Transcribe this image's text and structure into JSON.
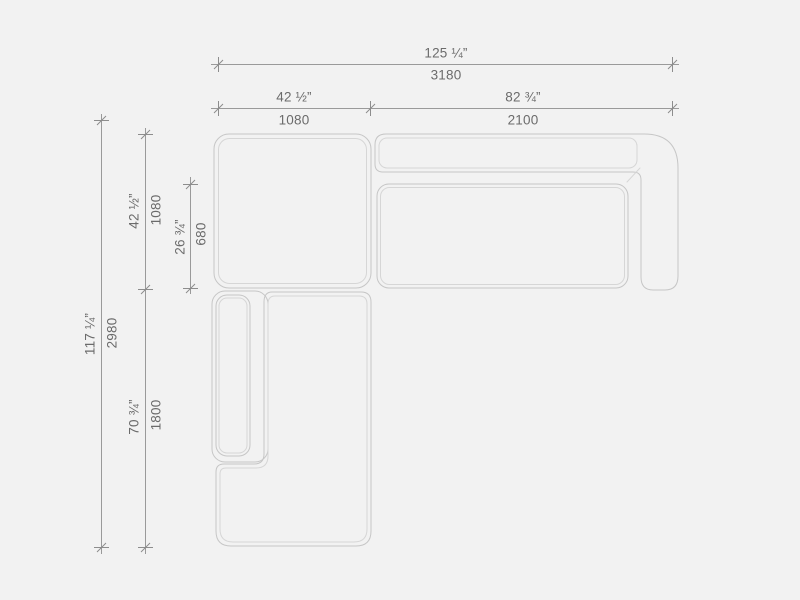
{
  "drawing": {
    "subject": "sectional-sofa-top-view",
    "modules": [
      "corner-ottoman",
      "right-arm-sofa",
      "left-chaise"
    ]
  },
  "colors": {
    "background": "#f2f2f2",
    "sofa_outline": "#c6c6c6",
    "sofa_outline_inner": "#d6d6d6",
    "dimension_line": "#9a9a9a",
    "text": "#6b6b6b"
  },
  "dimensions": {
    "overall_width": {
      "inches": "125 ¼”",
      "mm": "3180"
    },
    "left_section_width": {
      "inches": "42 ½”",
      "mm": "1080"
    },
    "right_section_width": {
      "inches": "82 ¾”",
      "mm": "2100"
    },
    "overall_depth": {
      "inches": "117 ¼”",
      "mm": "2980"
    },
    "top_section_depth": {
      "inches": "42 ½”",
      "mm": "1080"
    },
    "seat_depth": {
      "inches": "26 ¾”",
      "mm": "680"
    },
    "chaise_length": {
      "inches": "70 ¾”",
      "mm": "1800"
    }
  }
}
